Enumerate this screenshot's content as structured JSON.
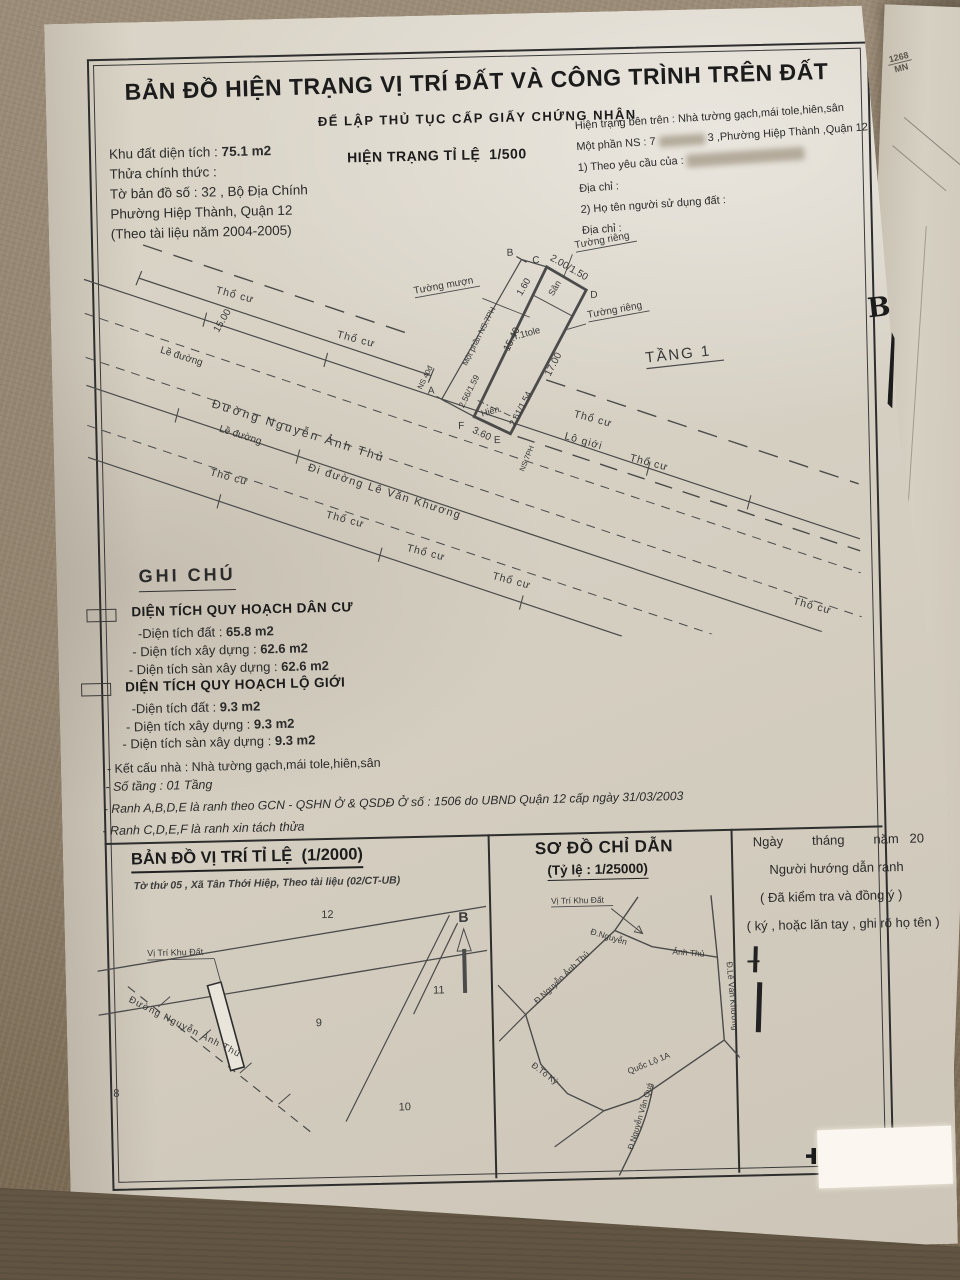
{
  "colors": {
    "paper": "#d6d0c3",
    "fabric": "#90816c",
    "ink": "#2b2b2b"
  },
  "doc": {
    "title": "BẢN ĐỒ HIỆN TRẠNG VỊ TRÍ ĐẤT VÀ CÔNG TRÌNH TRÊN ĐẤT",
    "subtitle": "ĐỂ LẬP THỦ TỤC CẤP GIẤY CHỨNG NHẬN"
  },
  "header": {
    "left": {
      "area_label": "Khu đất diện tích :",
      "area_value": "75.1 m2",
      "line2": "Thửa chính thức :",
      "line3": "Tờ bản đồ số : 32 , Bộ Địa Chính",
      "line4": "Phường Hiệp Thành, Quận 12",
      "line5": "(Theo tài liệu năm 2004-2005)"
    },
    "scale": "HIỆN TRẠNG TỈ LỆ  1/500",
    "right": {
      "line1": "Hiện trạng bên trên : Nhà tường gạch,mái tole,hiên,sân",
      "line2a": "Một phần NS : 7",
      "line2b": "3 ,Phường Hiệp Thành ,Quận 12",
      "line3": "1) Theo yêu cầu của :",
      "line4": "Địa chỉ :",
      "line5": "2) Họ tên người sử dụng đất :",
      "line6": "Địa chỉ :"
    }
  },
  "map": {
    "tho_cu": "Thổ cư",
    "le_duong": "Lề đường",
    "lo_gioi": "Lộ giới",
    "road_nguyen_anh_thu": "Đường Nguyễn Ảnh Thủ",
    "road_le_van_khuong": "Đi đường Lê Văn Khương",
    "tuong_rieng": "Tường riêng",
    "tuong_muon": "Tường mượn",
    "tang1": "TẦNG 1",
    "san": "Sân",
    "hien": "Hiên",
    "t1tole": "T.1tole",
    "mot_phan_ns": "Một phần NS:7PH",
    "ns7ph": "NS:7PH",
    "ns40": "NS 40đ",
    "m_15_00": "15.00",
    "m_1_60": "1.60",
    "m_2_00": "2.00/1.50",
    "m_15_40": "15.40",
    "m_17_00": "17.00",
    "m_2_56": "2.56/1.59",
    "m_2_61": "2.61/1.54",
    "m_3_60": "3.60",
    "p_a": "A",
    "p_b": "B",
    "p_c": "C",
    "p_d": "D",
    "p_e": "E",
    "p_f": "F"
  },
  "legend": {
    "title": "GHI CHÚ",
    "sections": [
      {
        "heading": "DIỆN TÍCH QUY HOẠCH DÂN CƯ",
        "rows": [
          {
            "label": "-Diện tích đất :",
            "value": "65.8 m2"
          },
          {
            "label": "- Diện tích xây dựng :",
            "value": "62.6 m2"
          },
          {
            "label": "- Diện tích sàn xây dựng :",
            "value": "62.6 m2"
          }
        ]
      },
      {
        "heading": "DIỆN TÍCH QUY HOẠCH LỘ GIỚI",
        "rows": [
          {
            "label": "-Diện tích đất :",
            "value": "9.3 m2"
          },
          {
            "label": "- Diện tích xây dựng :",
            "value": "9.3 m2"
          },
          {
            "label": "- Diện tích sàn xây dựng :",
            "value": "9.3 m2"
          }
        ]
      }
    ],
    "notes": [
      "- Kết cấu nhà : Nhà tường gạch,mái tole,hiên,sân",
      "- Số tầng : 01 Tầng",
      "- Ranh A,B,D,E là ranh theo GCN - QSHN Ở & QSDĐ Ở số : 1506 do UBND Quận 12 cấp ngày 31/03/2003",
      "- Ranh C,D,E,F là ranh xin tách thửa"
    ]
  },
  "location_map": {
    "title": "BẢN ĐỒ VỊ TRÍ TỈ LỆ  (1/2000)",
    "subtitle": "Tờ thứ 05 , Xã Tân Thới Hiệp, Theo tài liệu (02/CT-UB)",
    "plot_label": "Vị Trí Khu Đất",
    "parcels": [
      "12",
      "11",
      "9",
      "10",
      "8"
    ],
    "north": "B"
  },
  "guide_map": {
    "title": "SƠ ĐỒ CHỈ DẪN",
    "scale": "(Tỷ lệ : 1/25000)",
    "plot_label": "Vị Trí Khu Đất",
    "roads": {
      "nguyen_anh_thu": "Đ.Nguyễn Ảnh Thủ",
      "nguyen": "Đ.Nguyễn",
      "anh_thu": "Ảnh Thủ",
      "le_van_khuong": "Đ.Lê Văn Khương",
      "to_ky": "Đ.Tô Ký",
      "quoc_lo_1a": "Quốc Lộ 1A",
      "nguyen_van_qua": "Đ.Nguyễn Văn Quá"
    }
  },
  "signature": {
    "date_line": "Ngày        tháng        năm   20",
    "line1": "Người hướng dẫn ranh",
    "line2": "( Đã kiểm tra và đồng ý )",
    "line3": "( ký , hoặc lăn tay , ghi rõ họ tên )"
  },
  "photo": {
    "stamp_line1": "1268",
    "stamp_line2": "MN",
    "north_letter": "B"
  }
}
